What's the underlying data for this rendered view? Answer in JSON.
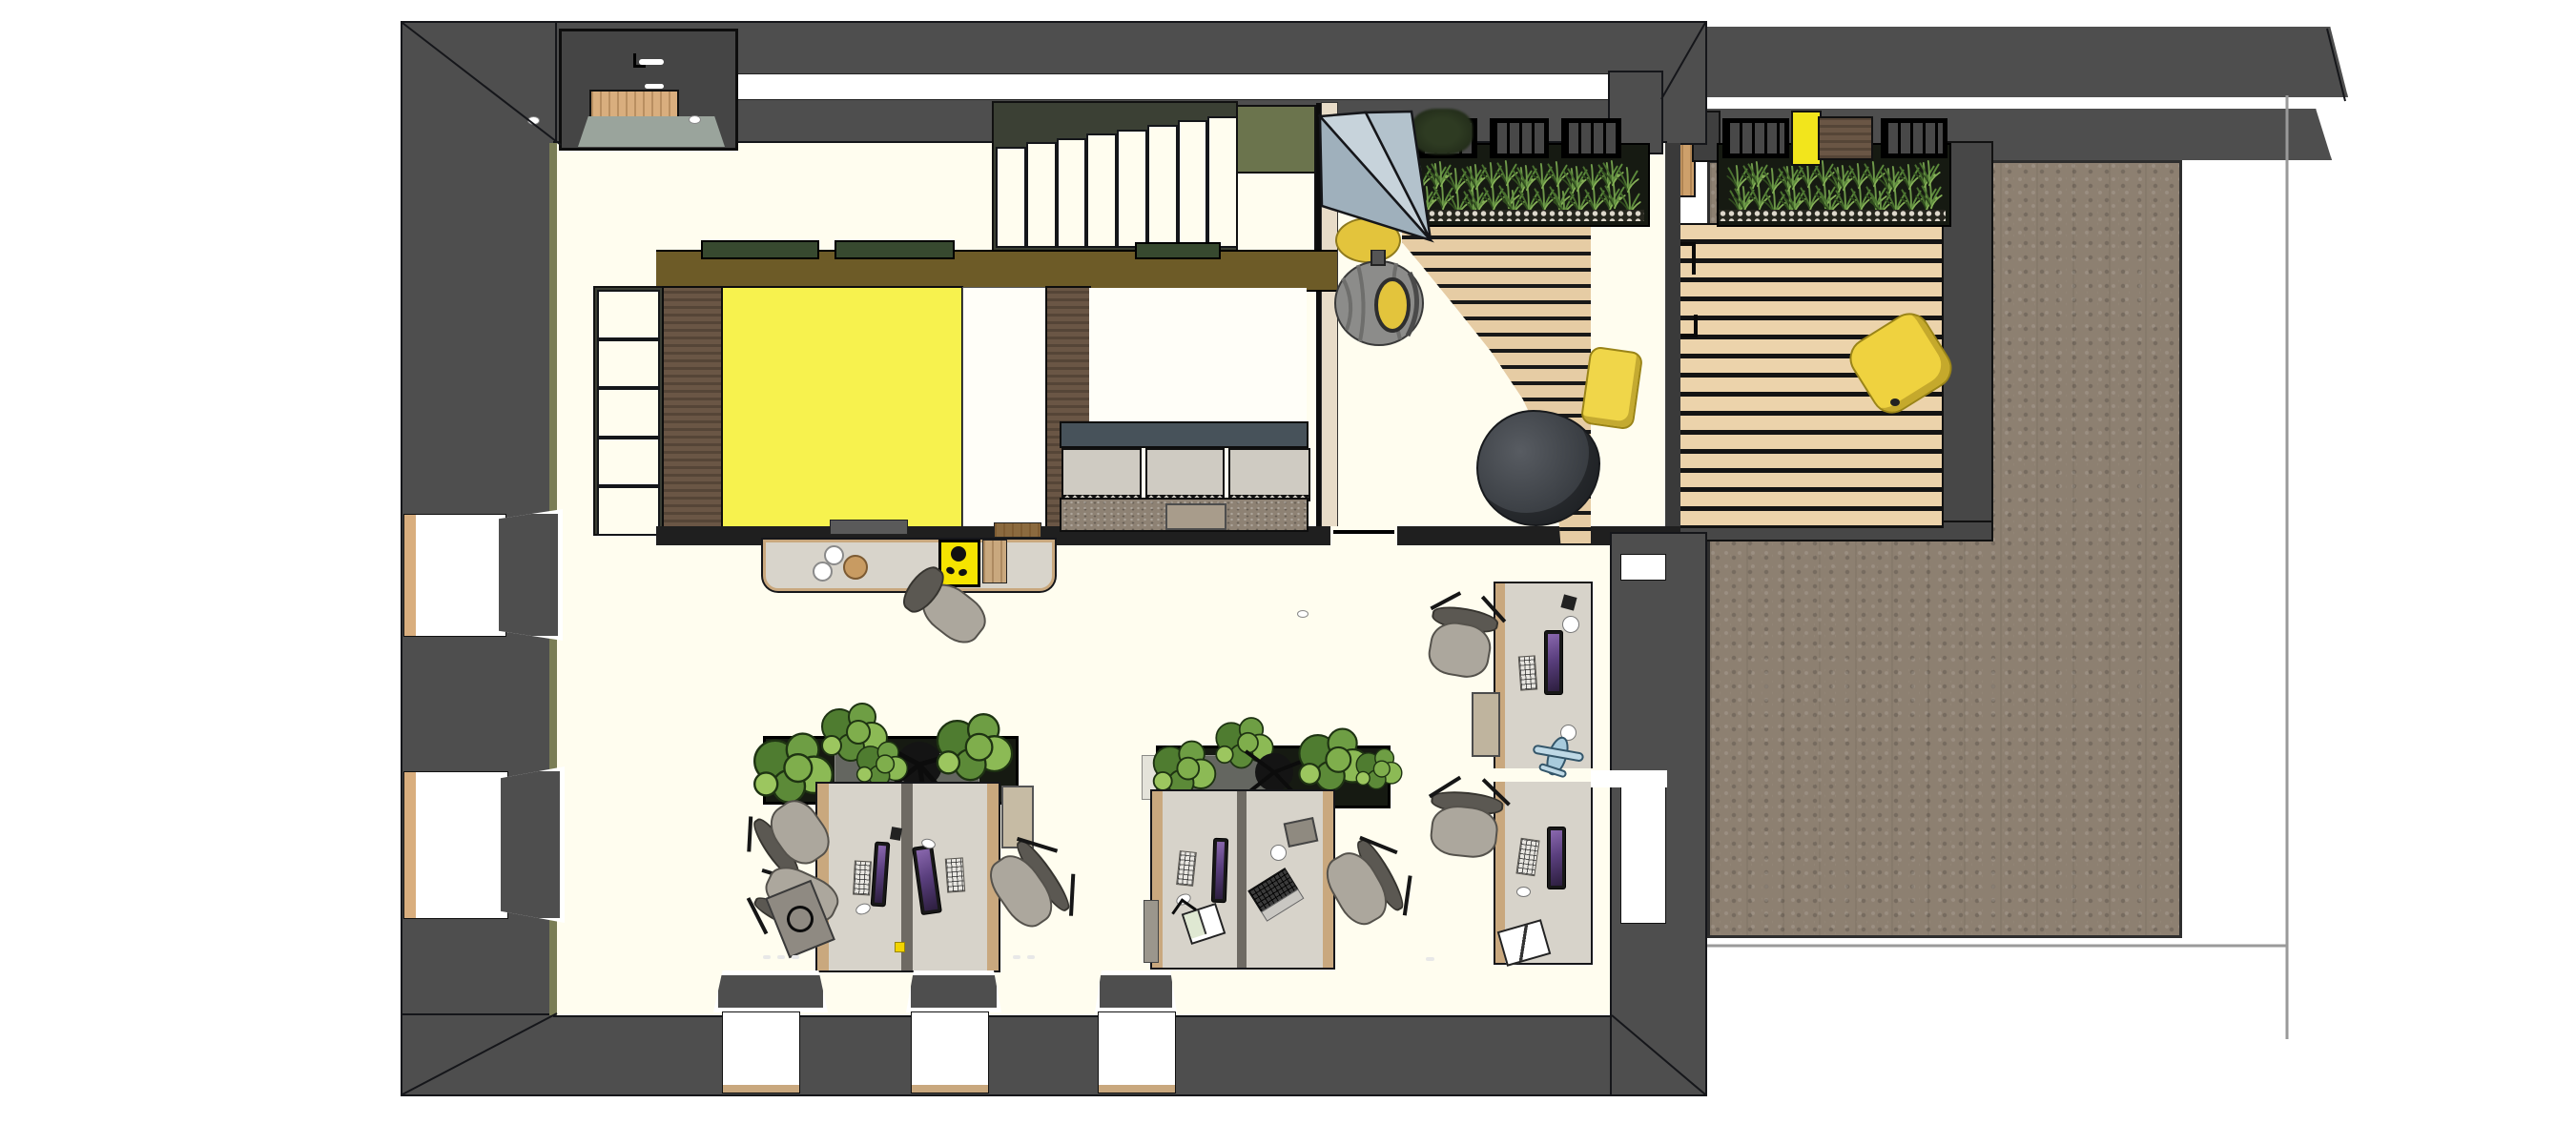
{
  "scene": {
    "kind": "3d-floor-plan-render",
    "view": "top-down",
    "rooms": [
      "entrance",
      "main-staircase",
      "yellow-meeting-room",
      "booth-seating-room",
      "lounge",
      "open-office",
      "terrace-deck",
      "paved-terrace"
    ],
    "furniture": [
      "credenza",
      "coffee-machine",
      "desk-cluster",
      "office-chair",
      "monitor",
      "keyboard",
      "laptop",
      "desk-planter",
      "teepee-tent",
      "hanging-egg-chair",
      "bean-bag",
      "amphitheater-steps",
      "grass-planter",
      "deck-cushion",
      "yellow-pillow"
    ]
  },
  "counts": {
    "main_stair_treads": 8,
    "side_stair_treads": 5,
    "booth_cushions": 3,
    "bottom_windows": 3,
    "left_windows": 2,
    "desk_clusters": 3,
    "tray_boxes_per_row": 3
  },
  "colors": {
    "wall": "#4E4E4E",
    "wallDark": "#3F3F3F",
    "floor": "#FFFDEF",
    "oliveEdge": "#7A7D55",
    "oliveBand": "#6D5B27",
    "glazeGreen": "#37492F",
    "roomYellow": "#F7F24E",
    "wallBrown": "#6A5645",
    "whitePanel": "#FFFEF8",
    "credenza": "#D8D4CB",
    "woodTrim": "#C9A87E",
    "benchSlate": "#47525A",
    "cushion": "#CFCBC2",
    "stone": "#8E8274",
    "partition": "#E8DCC8",
    "tentLight": "#C7D3DB",
    "tentMid": "#B3C2CC",
    "tentDark": "#9FB0BC",
    "eggGray": "#8C8C8A",
    "accentYellow": "#E3C43C",
    "brightYellow": "#F2E51C",
    "beanbag": "#3E4348",
    "slatWood": "#E6CCA4",
    "deckWood": "#ECD3AB",
    "soil": "#161A12",
    "pebble": "#DED8CC",
    "pavement": "#8D8071",
    "deskTop": "#D7D3CA",
    "chairSeat": "#ACA79D",
    "landingGray": "#9AA49C",
    "oliveLanding": "#6B744D",
    "doorWood": "#D9AE7E"
  }
}
